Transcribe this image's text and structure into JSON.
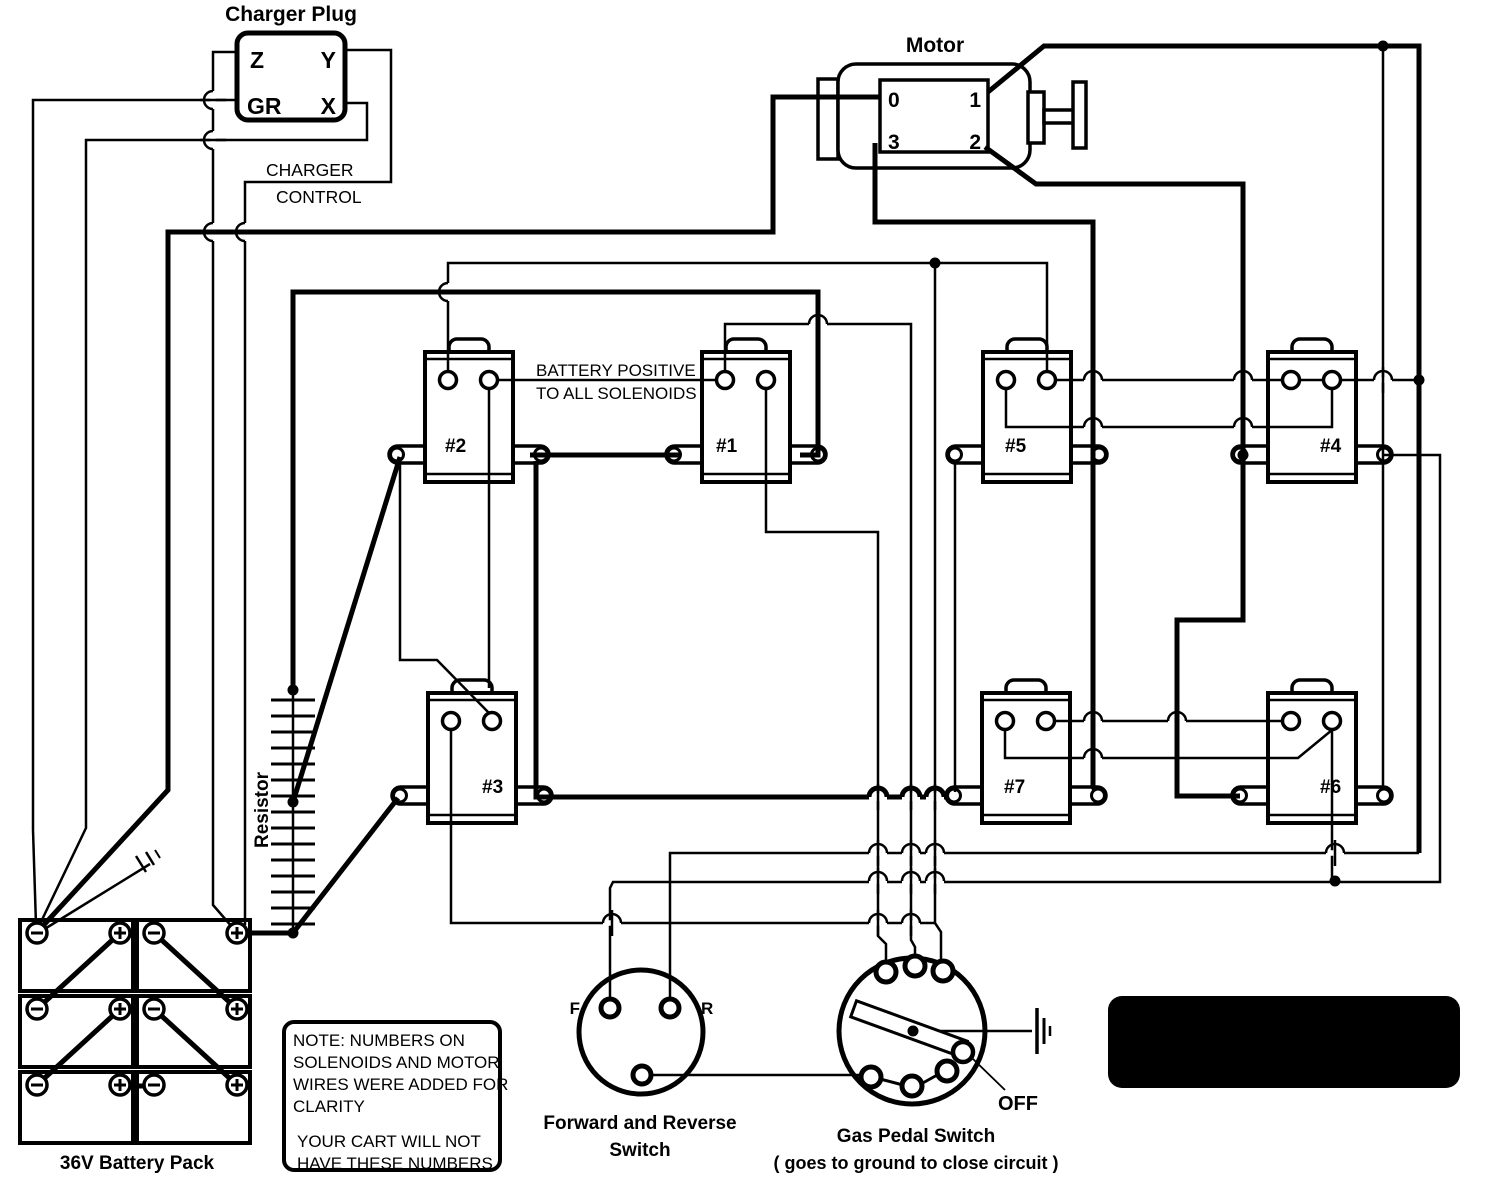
{
  "colors": {
    "wire": "#000000",
    "background": "#ffffff",
    "plate_bg": "#000000",
    "plate_fg": "#ffffff"
  },
  "charger_plug": {
    "title": "Charger Plug",
    "terminals": {
      "z": "Z",
      "y": "Y",
      "gr": "GR",
      "x": "X"
    },
    "control_line1": "CHARGER",
    "control_line2": "CONTROL"
  },
  "motor": {
    "title": "Motor",
    "terminals": {
      "t0": "0",
      "t1": "1",
      "t3": "3",
      "t2": "2"
    }
  },
  "solenoids": {
    "bus_label_line1": "BATTERY POSITIVE",
    "bus_label_line2": "TO ALL SOLENOIDS",
    "items": [
      {
        "label": "#1"
      },
      {
        "label": "#2"
      },
      {
        "label": "#3"
      },
      {
        "label": "#4"
      },
      {
        "label": "#5"
      },
      {
        "label": "#6"
      },
      {
        "label": "#7"
      }
    ]
  },
  "resistor": {
    "label": "Resistor"
  },
  "battery_pack": {
    "label": "36V Battery Pack",
    "minus_symbol": "−",
    "plus_symbol": "+"
  },
  "forward_reverse_switch": {
    "terminal_f": "F",
    "terminal_r": "R",
    "label_line1": "Forward and Reverse",
    "label_line2": "Switch"
  },
  "gas_pedal_switch": {
    "label_line1": "Gas Pedal Switch",
    "label_line2": "( goes to ground to close circuit )",
    "off_label": "OFF"
  },
  "title_plate": {
    "line1": "EARLY EZ-GO GOLF CART",
    "line2": "1950s"
  },
  "note_box": {
    "lines": [
      "NOTE: NUMBERS ON",
      "SOLENOIDS AND MOTOR",
      "WIRES WERE ADDED FOR",
      "CLARITY",
      "",
      "YOUR CART WILL NOT",
      "HAVE THESE NUMBERS"
    ]
  }
}
